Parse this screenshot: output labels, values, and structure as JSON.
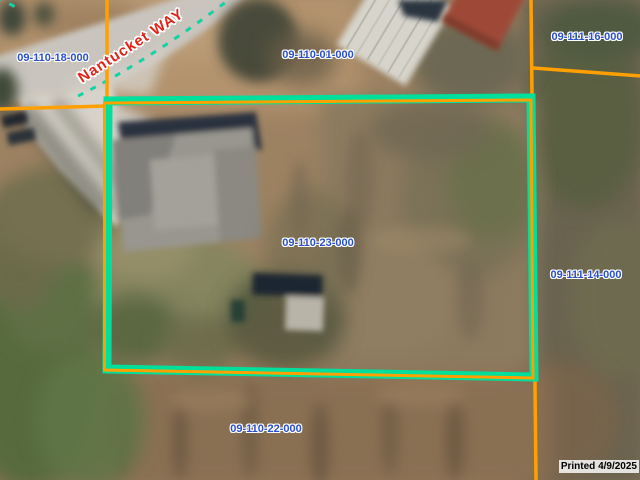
{
  "viewer": {
    "road_label": "Nantucket WAY",
    "printed_stamp": "Printed 4/9/2025",
    "selected_parcel": "09-110-23-000",
    "parcel_labels": [
      "09-110-18-000",
      "09-110-01-000",
      "09-111-16-000",
      "09-110-23-000",
      "09-111-14-000",
      "09-110-22-000"
    ],
    "colors": {
      "parcel_boundary": "#ffa000",
      "selection_highlight": "#00df9b",
      "road_centerline": "#14d2a2",
      "parcel_label_text": "#2b50c8",
      "road_label_text": "#e02418",
      "printed_text": "#000000"
    }
  }
}
